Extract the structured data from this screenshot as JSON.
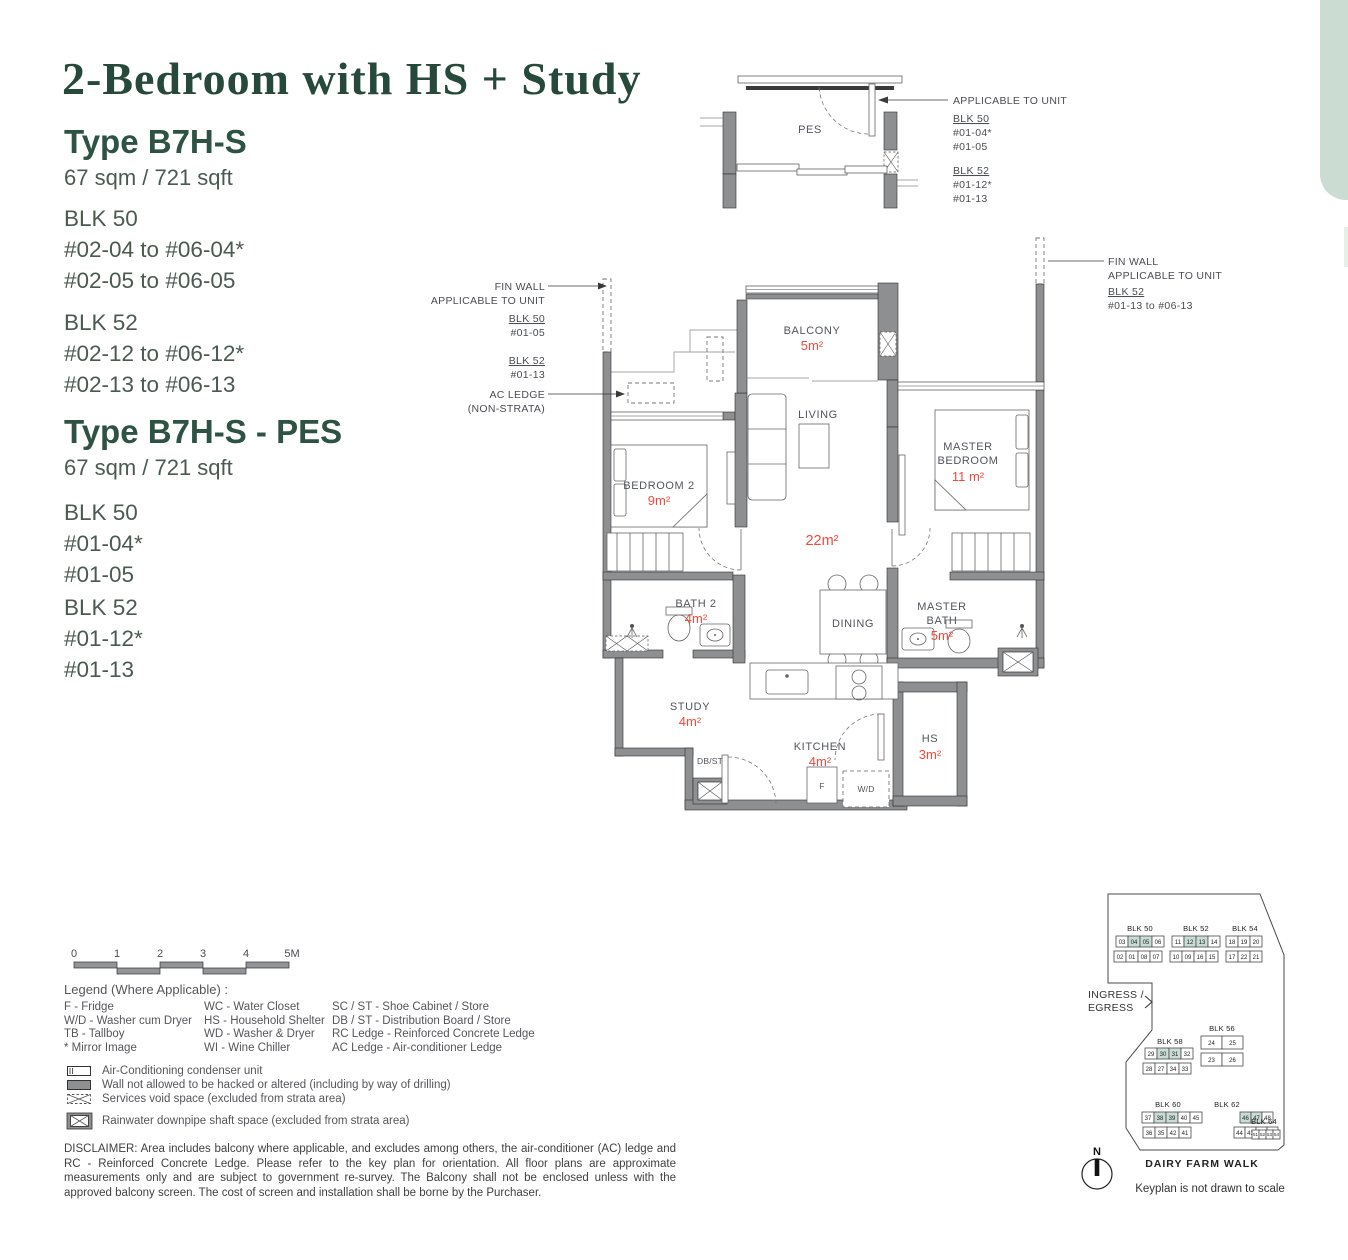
{
  "page": {
    "title": "2-Bedroom with HS + Study",
    "tab_color": "#cbdcd2",
    "accent_green": "#26493c",
    "area_red": "#f04a3d"
  },
  "types": [
    {
      "title": "Type B7H-S",
      "area": "67 sqm / 721 sqft",
      "blocks": [
        {
          "name": "BLK 50",
          "units": [
            "#02-04 to #06-04*",
            "#02-05 to #06-05"
          ]
        },
        {
          "name": "BLK 52",
          "units": [
            "#02-12 to #06-12*",
            "#02-13 to #06-13"
          ]
        }
      ]
    },
    {
      "title": "Type B7H-S - PES",
      "area": "67 sqm / 721 sqft",
      "blocks": [
        {
          "name": "BLK 50",
          "units": [
            "#01-04*",
            "#01-05"
          ]
        },
        {
          "name": "BLK 52",
          "units": [
            "#01-12*",
            "#01-13"
          ]
        }
      ]
    }
  ],
  "pes": {
    "room": "PES",
    "annotation": {
      "l1": "APPLICABLE TO UNIT",
      "blk1": "BLK 50",
      "u1a": "#01-04*",
      "u1b": "#01-05",
      "blk2": "BLK 52",
      "u2a": "#01-12*",
      "u2b": "#01-13"
    }
  },
  "floorplan": {
    "annotations": {
      "fin_wall_left": {
        "l1": "FIN WALL",
        "l2": "APPLICABLE TO UNIT",
        "blk1": "BLK 50",
        "u1": "#01-05",
        "blk2": "BLK 52",
        "u2": "#01-13"
      },
      "ac_ledge": {
        "l1": "AC LEDGE",
        "l2": "(NON-STRATA)"
      },
      "fin_wall_right": {
        "l1": "FIN WALL",
        "l2": "APPLICABLE TO UNIT",
        "blk": "BLK 52",
        "u": "#01-13 to #06-13"
      }
    },
    "rooms": {
      "balcony": {
        "name": "BALCONY",
        "area": "5m²"
      },
      "living": {
        "name": "LIVING",
        "area": "22m²"
      },
      "master_bedroom": {
        "l1": "MASTER",
        "l2": "BEDROOM",
        "area": "11 m²"
      },
      "bedroom2": {
        "name": "BEDROOM 2",
        "area": "9m²"
      },
      "bath2": {
        "name": "BATH 2",
        "area": "4m²"
      },
      "dining": {
        "name": "DINING"
      },
      "master_bath": {
        "l1": "MASTER",
        "l2": "BATH",
        "area": "5m²"
      },
      "study": {
        "name": "STUDY",
        "area": "4m²"
      },
      "kitchen": {
        "name": "KITCHEN",
        "area": "4m²"
      },
      "hs": {
        "name": "HS",
        "area": "3m²"
      },
      "db_st": {
        "name": "DB/ST"
      },
      "fridge": {
        "name": "F"
      },
      "washer": {
        "name": "W/D"
      }
    }
  },
  "scalebar": {
    "ticks": [
      "0",
      "1",
      "2",
      "3",
      "4",
      "5M"
    ]
  },
  "legend": {
    "title": "Legend (Where Applicable) :",
    "columns": [
      [
        "F - Fridge",
        "W/D - Washer cum Dryer",
        "TB - Tallboy",
        "* Mirror Image"
      ],
      [
        "WC - Water Closet",
        "HS - Household Shelter",
        "WD - Washer & Dryer",
        "WI  - Wine Chiller"
      ],
      [
        "SC / ST - Shoe Cabinet / Store",
        "DB / ST - Distribution Board / Store",
        "RC Ledge - Reinforced Concrete Ledge",
        "AC Ledge - Air-conditioner Ledge"
      ]
    ],
    "symbols": [
      {
        "icon": "ac-condenser-symbol",
        "label": "Air-Conditioning condenser unit"
      },
      {
        "icon": "no-hack-wall-symbol",
        "label": "Wall not allowed to be hacked or altered (including by way of drilling)"
      },
      {
        "icon": "services-void-symbol",
        "label": "Services void space (excluded from strata area)"
      },
      {
        "icon": "rainwater-shaft-symbol",
        "label": "Rainwater downpipe shaft space (excluded from strata area)"
      }
    ]
  },
  "disclaimer": "DISCLAIMER: Area includes balcony where applicable, and excludes among others, the air-conditioner (AC) ledge and RC - Reinforced Concrete Ledge. Please refer to the key plan for orientation. All floor plans are approximate measurements only and are subject to government re-survey. The Balcony shall not be enclosed unless with the approved balcony screen. The cost of screen and installation shall be borne by the Purchaser.",
  "keyplan": {
    "ingress_line1": "INGRESS /",
    "ingress_line2": "EGRESS",
    "street": "DAIRY FARM WALK",
    "note": "Keyplan is not drawn to scale",
    "compass": "N",
    "highlight_color": "#c9ddd6",
    "blocks": [
      {
        "name": "BLK 50",
        "label_x": 1140,
        "label_y": 931,
        "highlight": [
          "04",
          "05"
        ],
        "rows": [
          {
            "x": 1116,
            "y": 936,
            "cells": [
              "03",
              "04",
              "05",
              "06"
            ]
          },
          {
            "x": 1114,
            "y": 951,
            "cells": [
              "02",
              "01",
              "08",
              "07"
            ]
          }
        ]
      },
      {
        "name": "BLK 52",
        "label_x": 1196,
        "label_y": 931,
        "highlight": [
          "12",
          "13"
        ],
        "rows": [
          {
            "x": 1172,
            "y": 936,
            "cells": [
              "11",
              "12",
              "13",
              "14"
            ]
          },
          {
            "x": 1170,
            "y": 951,
            "cells": [
              "10",
              "09",
              "16",
              "15"
            ]
          }
        ]
      },
      {
        "name": "BLK 54",
        "label_x": 1245,
        "label_y": 931,
        "highlight": [],
        "rows": [
          {
            "x": 1226,
            "y": 936,
            "cells": [
              "18",
              "19",
              "20"
            ]
          },
          {
            "x": 1226,
            "y": 951,
            "cells": [
              "17",
              "22",
              "21"
            ]
          }
        ]
      },
      {
        "name": "BLK 58",
        "label_x": 1170,
        "label_y": 1044,
        "highlight": [
          "30",
          "31"
        ],
        "rows": [
          {
            "x": 1145,
            "y": 1048,
            "cells": [
              "29",
              "30",
              "31",
              "32"
            ]
          },
          {
            "x": 1143,
            "y": 1063,
            "cells": [
              "28",
              "27",
              "34",
              "33"
            ]
          }
        ]
      },
      {
        "name": "BLK 56",
        "label_x": 1222,
        "label_y": 1031,
        "highlight": [],
        "w": 21,
        "h": 13,
        "rows": [
          {
            "x": 1201,
            "y": 1036,
            "cells": [
              "24",
              "25"
            ]
          },
          {
            "x": 1201,
            "y": 1053,
            "cells": [
              "23",
              "26"
            ]
          }
        ]
      },
      {
        "name": "BLK 60",
        "label_x": 1168,
        "label_y": 1107,
        "highlight": [
          "38",
          "39"
        ],
        "rows": [
          {
            "x": 1142,
            "y": 1112,
            "cells": [
              "37",
              "38",
              "39",
              "40",
              "45"
            ]
          },
          {
            "x": 1143,
            "y": 1127,
            "cells": [
              "36",
              "35",
              "42",
              "41"
            ]
          }
        ]
      },
      {
        "name": "BLK 62",
        "label_x": 1227,
        "label_y": 1107,
        "highlight": [
          "46",
          "47"
        ],
        "w": 11,
        "rows": [
          {
            "x": 1240,
            "y": 1112,
            "cells": [
              "46",
              "47",
              "48"
            ]
          },
          {
            "x": 1234,
            "y": 1127,
            "cells": [
              "44",
              "43",
              "50",
              "49"
            ]
          }
        ]
      },
      {
        "name": "BLK 64",
        "label_x": 1264,
        "label_y": 1124,
        "highlight": [],
        "w": 7,
        "h": 9,
        "fs": 4.5,
        "rows": [
          {
            "x": 1252,
            "y": 1130,
            "cells": [
              "51",
              "52",
              "53",
              "54"
            ]
          }
        ]
      }
    ]
  }
}
